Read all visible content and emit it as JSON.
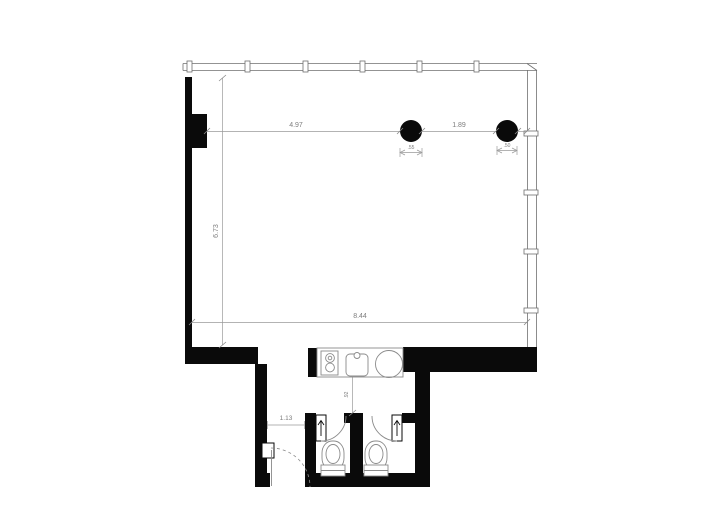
{
  "page": {
    "background": "#ffffff",
    "description": "Architectural floor plan, black walls on white"
  },
  "plan": {
    "colors": {
      "wall": "#0a0a0a",
      "line": "#8f8f8f",
      "glaze": "#6f6f6f",
      "dim": "#7d7d7d",
      "bg": "#ffffff"
    },
    "labels": {
      "dim_pier_to_column": "4.97",
      "dim_column_spacing": "1.89",
      "dim_column1_size": ".55",
      "dim_column2_size": ".50",
      "dim_room_depth": "6.73",
      "dim_room_width": "8.44",
      "dim_entry_width": "1.13",
      "dim_service_gap": ".92"
    },
    "fixtures": [
      "column",
      "column",
      "cooktop",
      "kitchen-sink",
      "round-fixture",
      "toilet",
      "toilet",
      "entry-door",
      "stall-door",
      "stall-door"
    ]
  }
}
